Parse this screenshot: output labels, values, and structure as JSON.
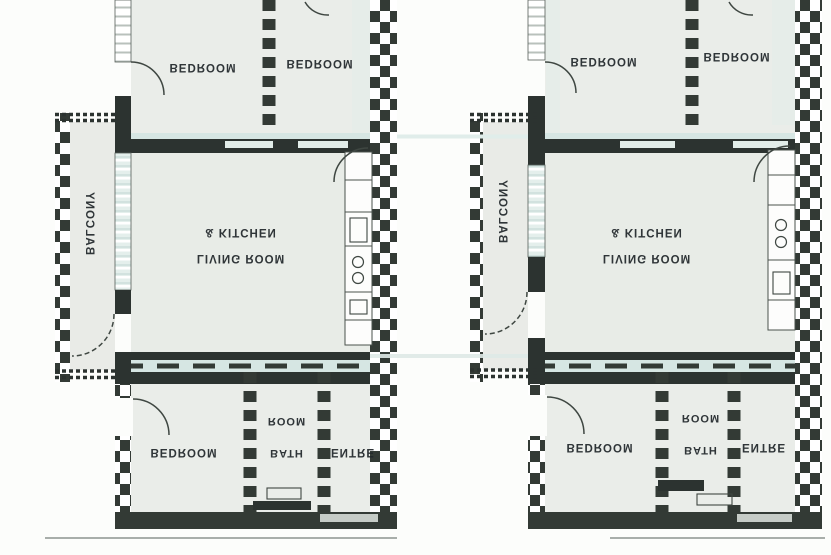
{
  "page": {
    "background": "#fcfdfb"
  },
  "palette": {
    "wall": "#333a35",
    "wall_dark": "#2c3330",
    "room_fill": "#eaede9",
    "living_fill": "#e8ece7",
    "balcony_fill": "#e9ebe7",
    "window_blue": "#d6e6e3",
    "window_tint": "#e2ede9",
    "threshold": "#c6ccc7",
    "thin_line": "#a8aeaa",
    "arc_line": "#3f4742",
    "counter": "#fdfdfc",
    "text": "#20262a"
  },
  "units": [
    {
      "name": "left-apartment",
      "rooms": {
        "bedroom_top_left": "BEDROOM",
        "bedroom_top_right": "BEDROOM",
        "balcony": "BALCONY",
        "living_line1": "LIVING ROOM",
        "living_line2": "& KITCHEN",
        "bedroom_bottom": "BEDROOM",
        "bath_line1": "BATH",
        "bath_line2": "ROOM",
        "entre": "ENTRE"
      }
    },
    {
      "name": "right-apartment",
      "rooms": {
        "bedroom_top_left": "BEDROOM",
        "bedroom_top_right": "BEDROOM",
        "balcony": "BALCONY",
        "living_line1": "LIVING ROOM",
        "living_line2": "& KITCHEN",
        "bedroom_bottom": "BEDROOM",
        "bath_line1": "BATH",
        "bath_line2": "ROOM",
        "entre": "ENTRE"
      }
    }
  ]
}
